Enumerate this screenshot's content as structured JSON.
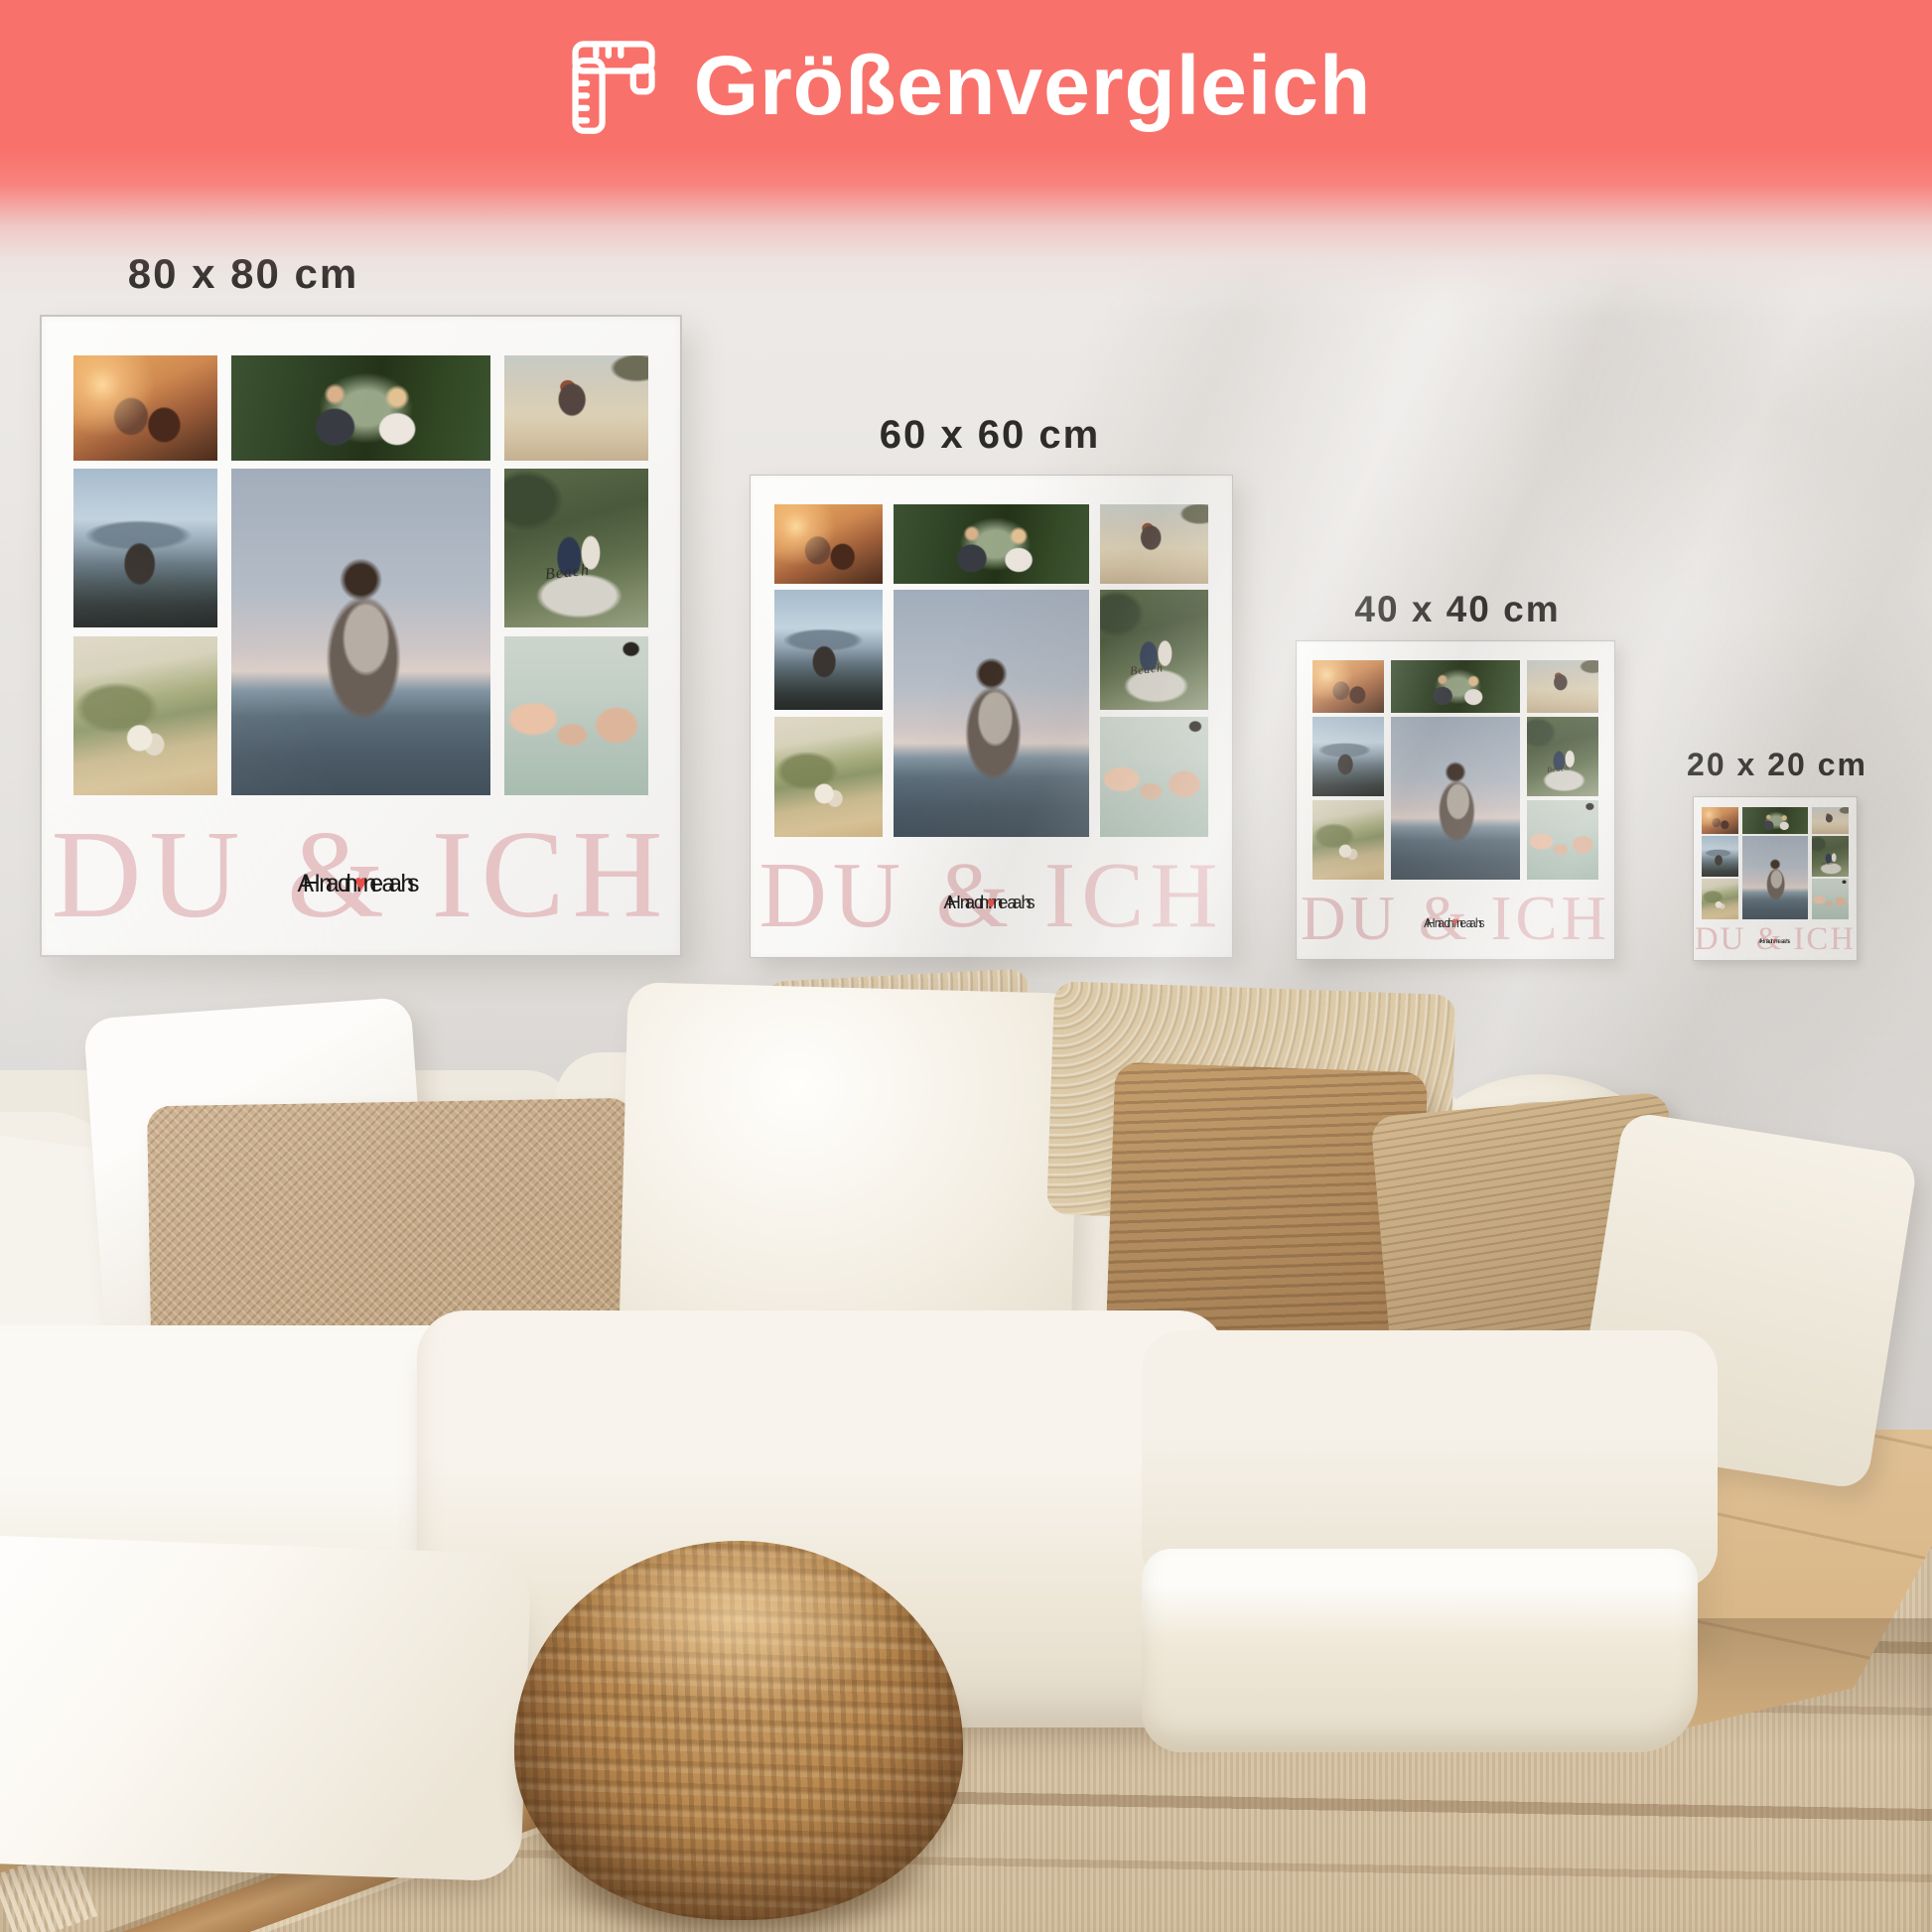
{
  "header": {
    "title": "Größenvergleich",
    "icon": "ruler-icon",
    "background_color": "#f9716b",
    "text_color": "#ffffff"
  },
  "posters": [
    {
      "label": "80 x 80 cm"
    },
    {
      "label": "60 x 60 cm"
    },
    {
      "label": "40 x 40 cm"
    },
    {
      "label": "20 x 20 cm"
    }
  ],
  "collage": {
    "title": "DU & ICH",
    "title_color": "#e6c3c5",
    "name_left": "Andreas",
    "name_right": "Hannah",
    "heart_glyph": "♥",
    "heart_color": "#e8504a",
    "boat_text": "Beach",
    "photos": [
      "couple-sunset-overlook",
      "wedding-couple-park",
      "couple-piggyback-beach",
      "couple-mountain-view",
      "couple-embrace-seaside",
      "couple-in-boat",
      "couple-beach-dunes",
      "hands-pinky-promise"
    ]
  },
  "scene": {
    "wall_color": "#e2dfdc",
    "sofa_color": "#f2eee5",
    "pillow_colors": [
      "#fdfcfa",
      "#c7ab87",
      "#d9c7a9",
      "#b08d62",
      "#c4a87f",
      "#efe8da"
    ],
    "rug_color": "#d9c6a8",
    "pouf_color": "#b8884f",
    "floor_color": "#d8b586"
  }
}
